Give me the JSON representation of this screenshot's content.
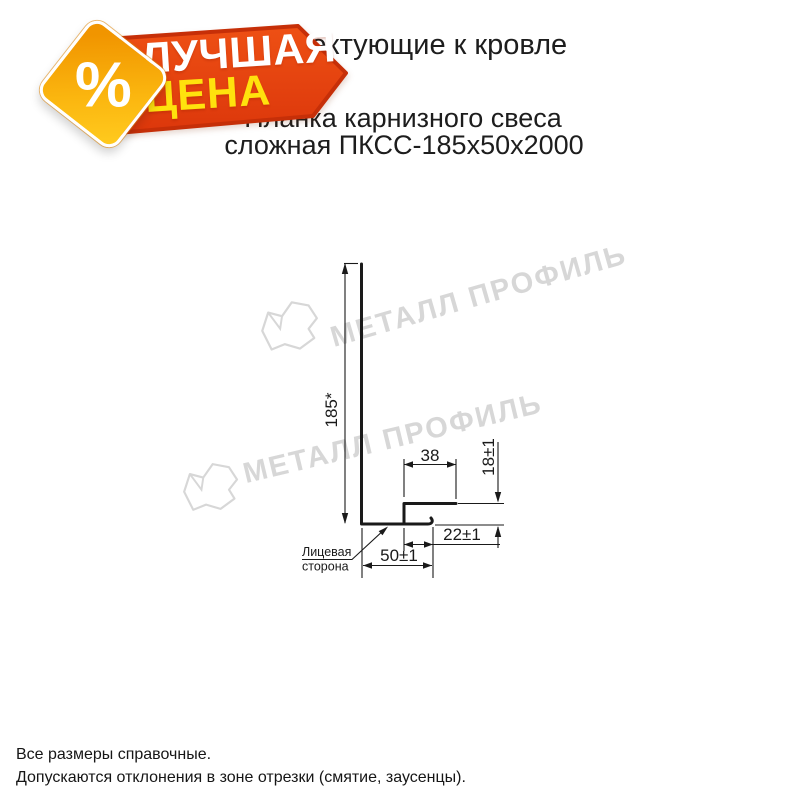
{
  "badge": {
    "percent_symbol": "%",
    "label_line1": "ЛУЧШАЯ",
    "label_line2": "ЦЕНА",
    "ribbon_fill": "#e8430e",
    "ribbon_border": "#c62f08",
    "diamond_gradient_start": "#f19500",
    "diamond_gradient_end": "#ffc91d",
    "line1_color": "#ffffff",
    "line2_color": "#ffe20d"
  },
  "header": {
    "title": "Комплектующие к кровле",
    "subtitle_line1": "Планка карнизного свеса",
    "subtitle_line2": "сложная ПКСС-185х50х2000"
  },
  "watermark": {
    "text": "МЕТАЛЛ ПРОФИЛЬ",
    "color": "#d7d7d7"
  },
  "drawing": {
    "dim_height": "185*",
    "dim_flange_width": "38",
    "dim_lip_height": "18±1",
    "dim_hem_width": "22±1",
    "dim_bottom_width": "50±1",
    "face_label_line1": "Лицевая",
    "face_label_line2": "сторона",
    "line_color": "#1a1a1a"
  },
  "footnotes": [
    "Все размеры справочные.",
    "Допускаются отклонения в зоне отрезки (смятие, заусенцы)."
  ]
}
